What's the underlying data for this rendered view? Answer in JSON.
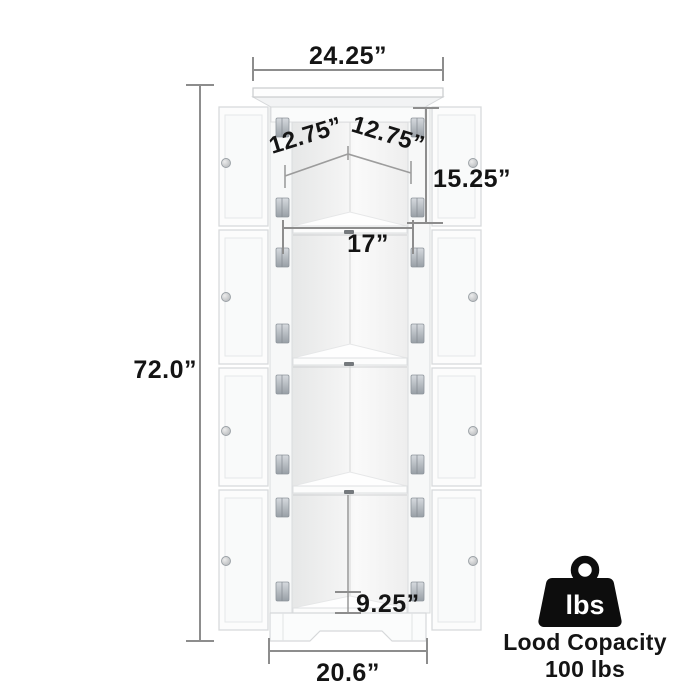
{
  "dimensions": {
    "top_width": "24.25”",
    "left_shelf_depth": "12.75”",
    "right_shelf_depth": "12.75”",
    "top_section_height": "15.25”",
    "middle_shelf_width": "17”",
    "overall_height": "72.0”",
    "bottom_section_height": "9.25”",
    "bottom_width": "20.6”"
  },
  "load_capacity": {
    "icon": "weight-icon",
    "icon_text": "lbs",
    "line1": "Lood Copacity",
    "line2": "100 lbs"
  },
  "colors": {
    "background": "#ffffff",
    "dimension_line": "#8d8d8d",
    "label_text": "#141414",
    "cabinet_outline": "#d8dadc",
    "cabinet_fill": "#fcfcfc",
    "interior_shade": "#ebebeb",
    "hinge_metal": "#a6adb4",
    "knob_metal": "#c3c6c9",
    "capacity_icon": "#0d0d0d"
  }
}
